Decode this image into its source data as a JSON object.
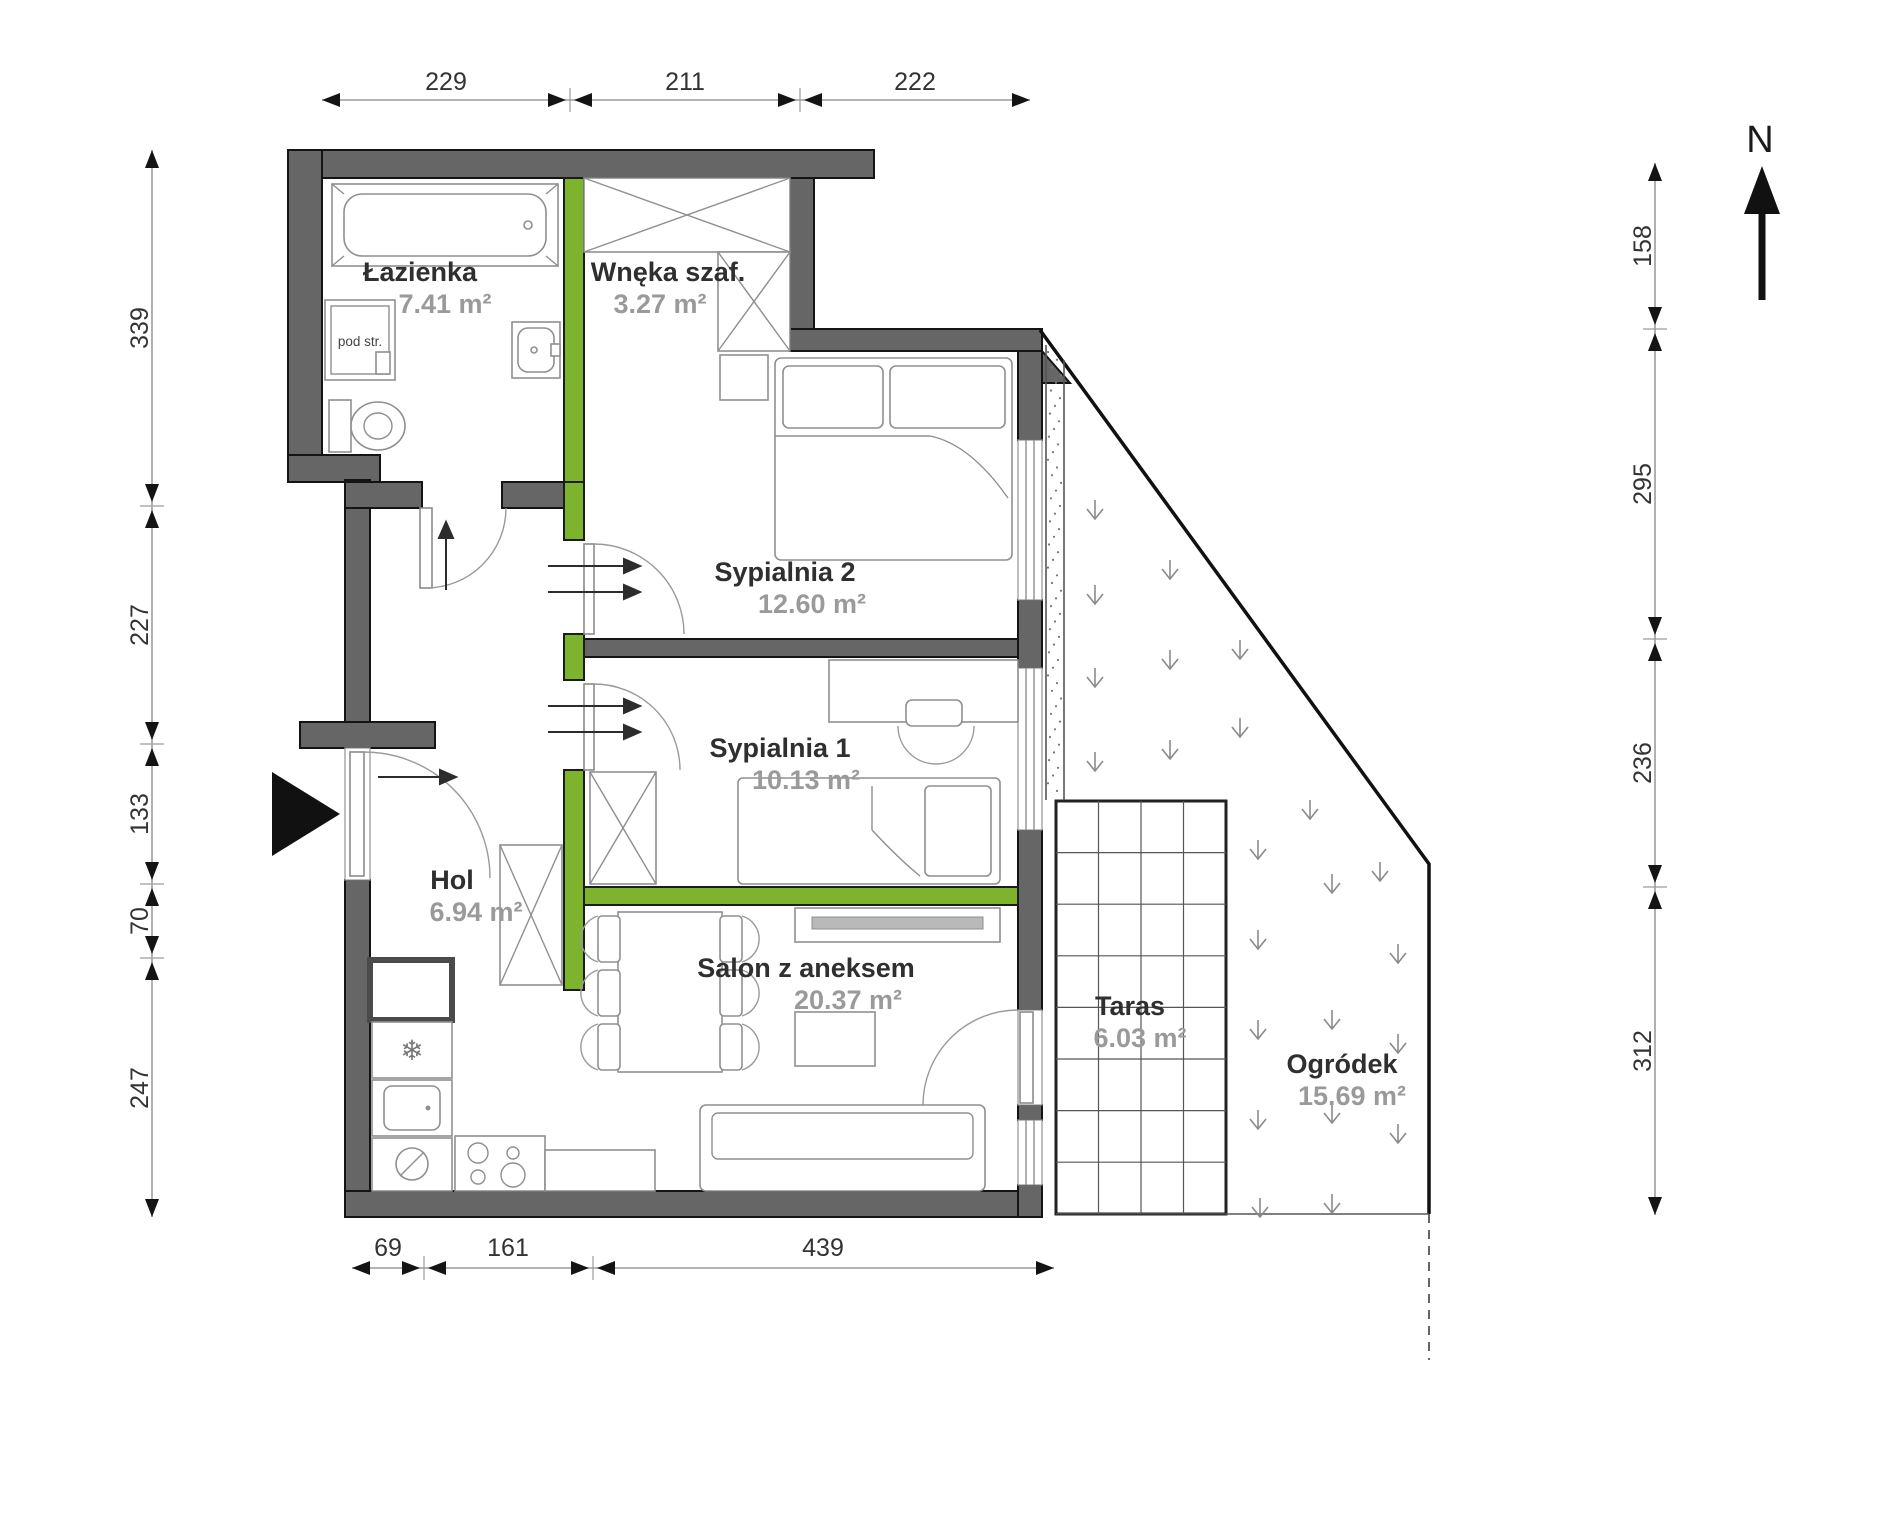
{
  "rooms": [
    {
      "id": "lazienka",
      "name": "Łazienka",
      "area": "7.41 m²"
    },
    {
      "id": "wneka",
      "name": "Wnęka szaf.",
      "area": "3.27 m²"
    },
    {
      "id": "sypialnia2",
      "name": "Sypialnia 2",
      "area": "12.60 m²"
    },
    {
      "id": "sypialnia1",
      "name": "Sypialnia 1",
      "area": "10.13 m²"
    },
    {
      "id": "hol",
      "name": "Hol",
      "area": "6.94 m²"
    },
    {
      "id": "salon",
      "name": "Salon z aneksem",
      "area": "20.37 m²"
    },
    {
      "id": "taras",
      "name": "Taras",
      "area": "6.03 m²"
    },
    {
      "id": "ogrodek",
      "name": "Ogródek",
      "area": "15.69 m²"
    }
  ],
  "dimensions_cm": {
    "top": [
      "229",
      "211",
      "222"
    ],
    "left": [
      "339",
      "227",
      "133",
      "70",
      "247"
    ],
    "right": [
      "158",
      "295",
      "236",
      "312"
    ],
    "bottom": [
      "69",
      "161",
      "439"
    ]
  },
  "compass": {
    "north_label": "N"
  },
  "labels": {
    "washer": "pod str."
  },
  "colors": {
    "wall_gray": "#666666",
    "wall_green": "#7db32d",
    "room_text": "#2f2f2f",
    "area_text": "#9a9a9a",
    "dim_text": "#333333"
  }
}
